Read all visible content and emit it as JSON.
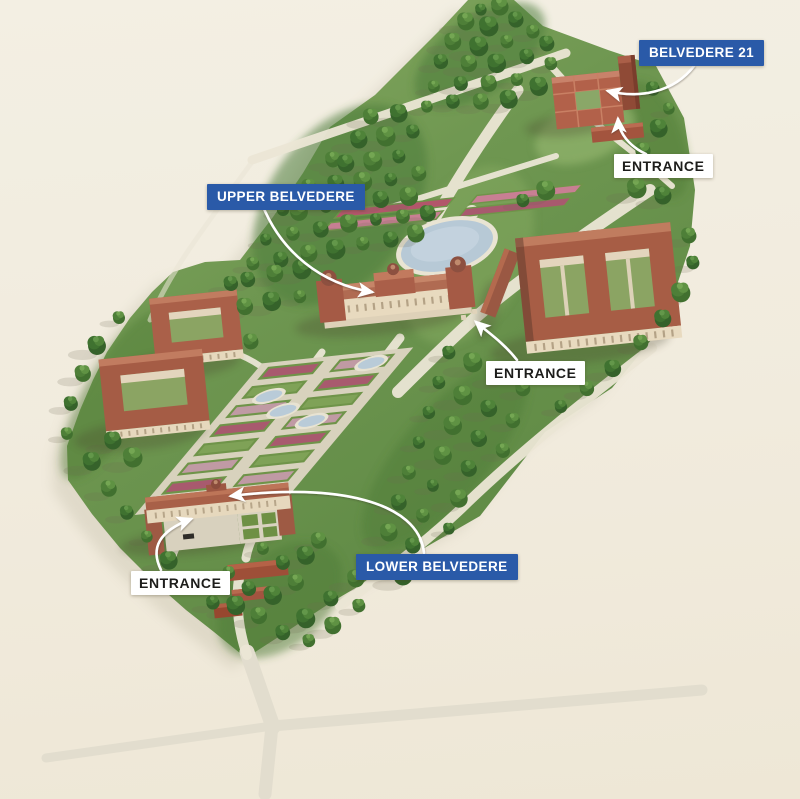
{
  "labels": {
    "belvedere_21": "BELVEDERE 21",
    "upper_belvedere": "UPPER BELVEDERE",
    "lower_belvedere": "LOWER BELVEDERE",
    "entrances": [
      "ENTRANCE",
      "ENTRANCE",
      "ENTRANCE"
    ]
  },
  "colors": {
    "accent_blue": "#2a5aa8",
    "label_text_dark": "#1d1d1b",
    "background_cream": "#f1ecdf",
    "park_green": "#7ba055",
    "forest_green": "#49762f",
    "roof_terracotta": "#a75d45",
    "facade_cream": "#e8dabf",
    "pond_blue": "#b7c9d6",
    "path_beige": "#ebe6d5",
    "arrow_white": "#ffffff"
  }
}
